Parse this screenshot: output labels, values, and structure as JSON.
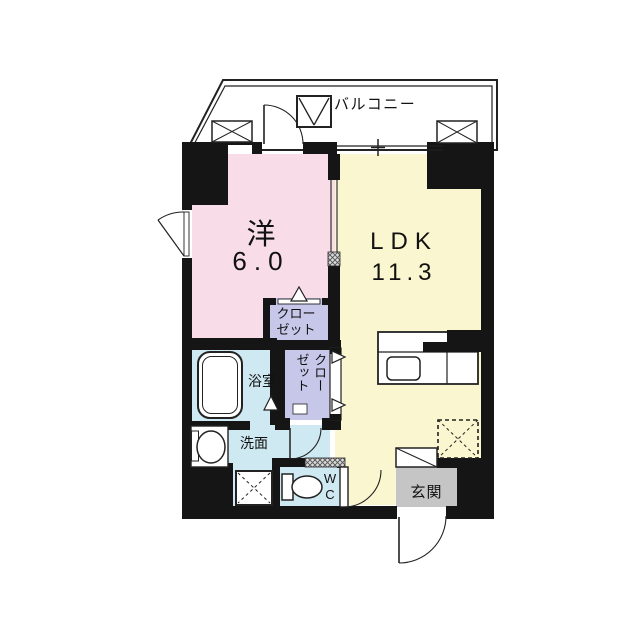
{
  "colors": {
    "wall": "#151515",
    "line": "#222222",
    "western_room": "#f8dde8",
    "ldk": "#faf6cf",
    "closet": "#c7c7ea",
    "wet_area": "#cfe9f3",
    "entrance_floor": "#c5c5c5"
  },
  "labels": {
    "balcony": "バルコニー",
    "western_name": "洋",
    "western_size": "6.0",
    "ldk_name": "LDK",
    "ldk_size": "11.3",
    "closet_upper": "クロー\nゼット",
    "closet_lower": "クロー\nゼット",
    "bathroom": "浴室",
    "washroom": "洗面",
    "wc": "W\nC",
    "entrance": "玄関"
  }
}
